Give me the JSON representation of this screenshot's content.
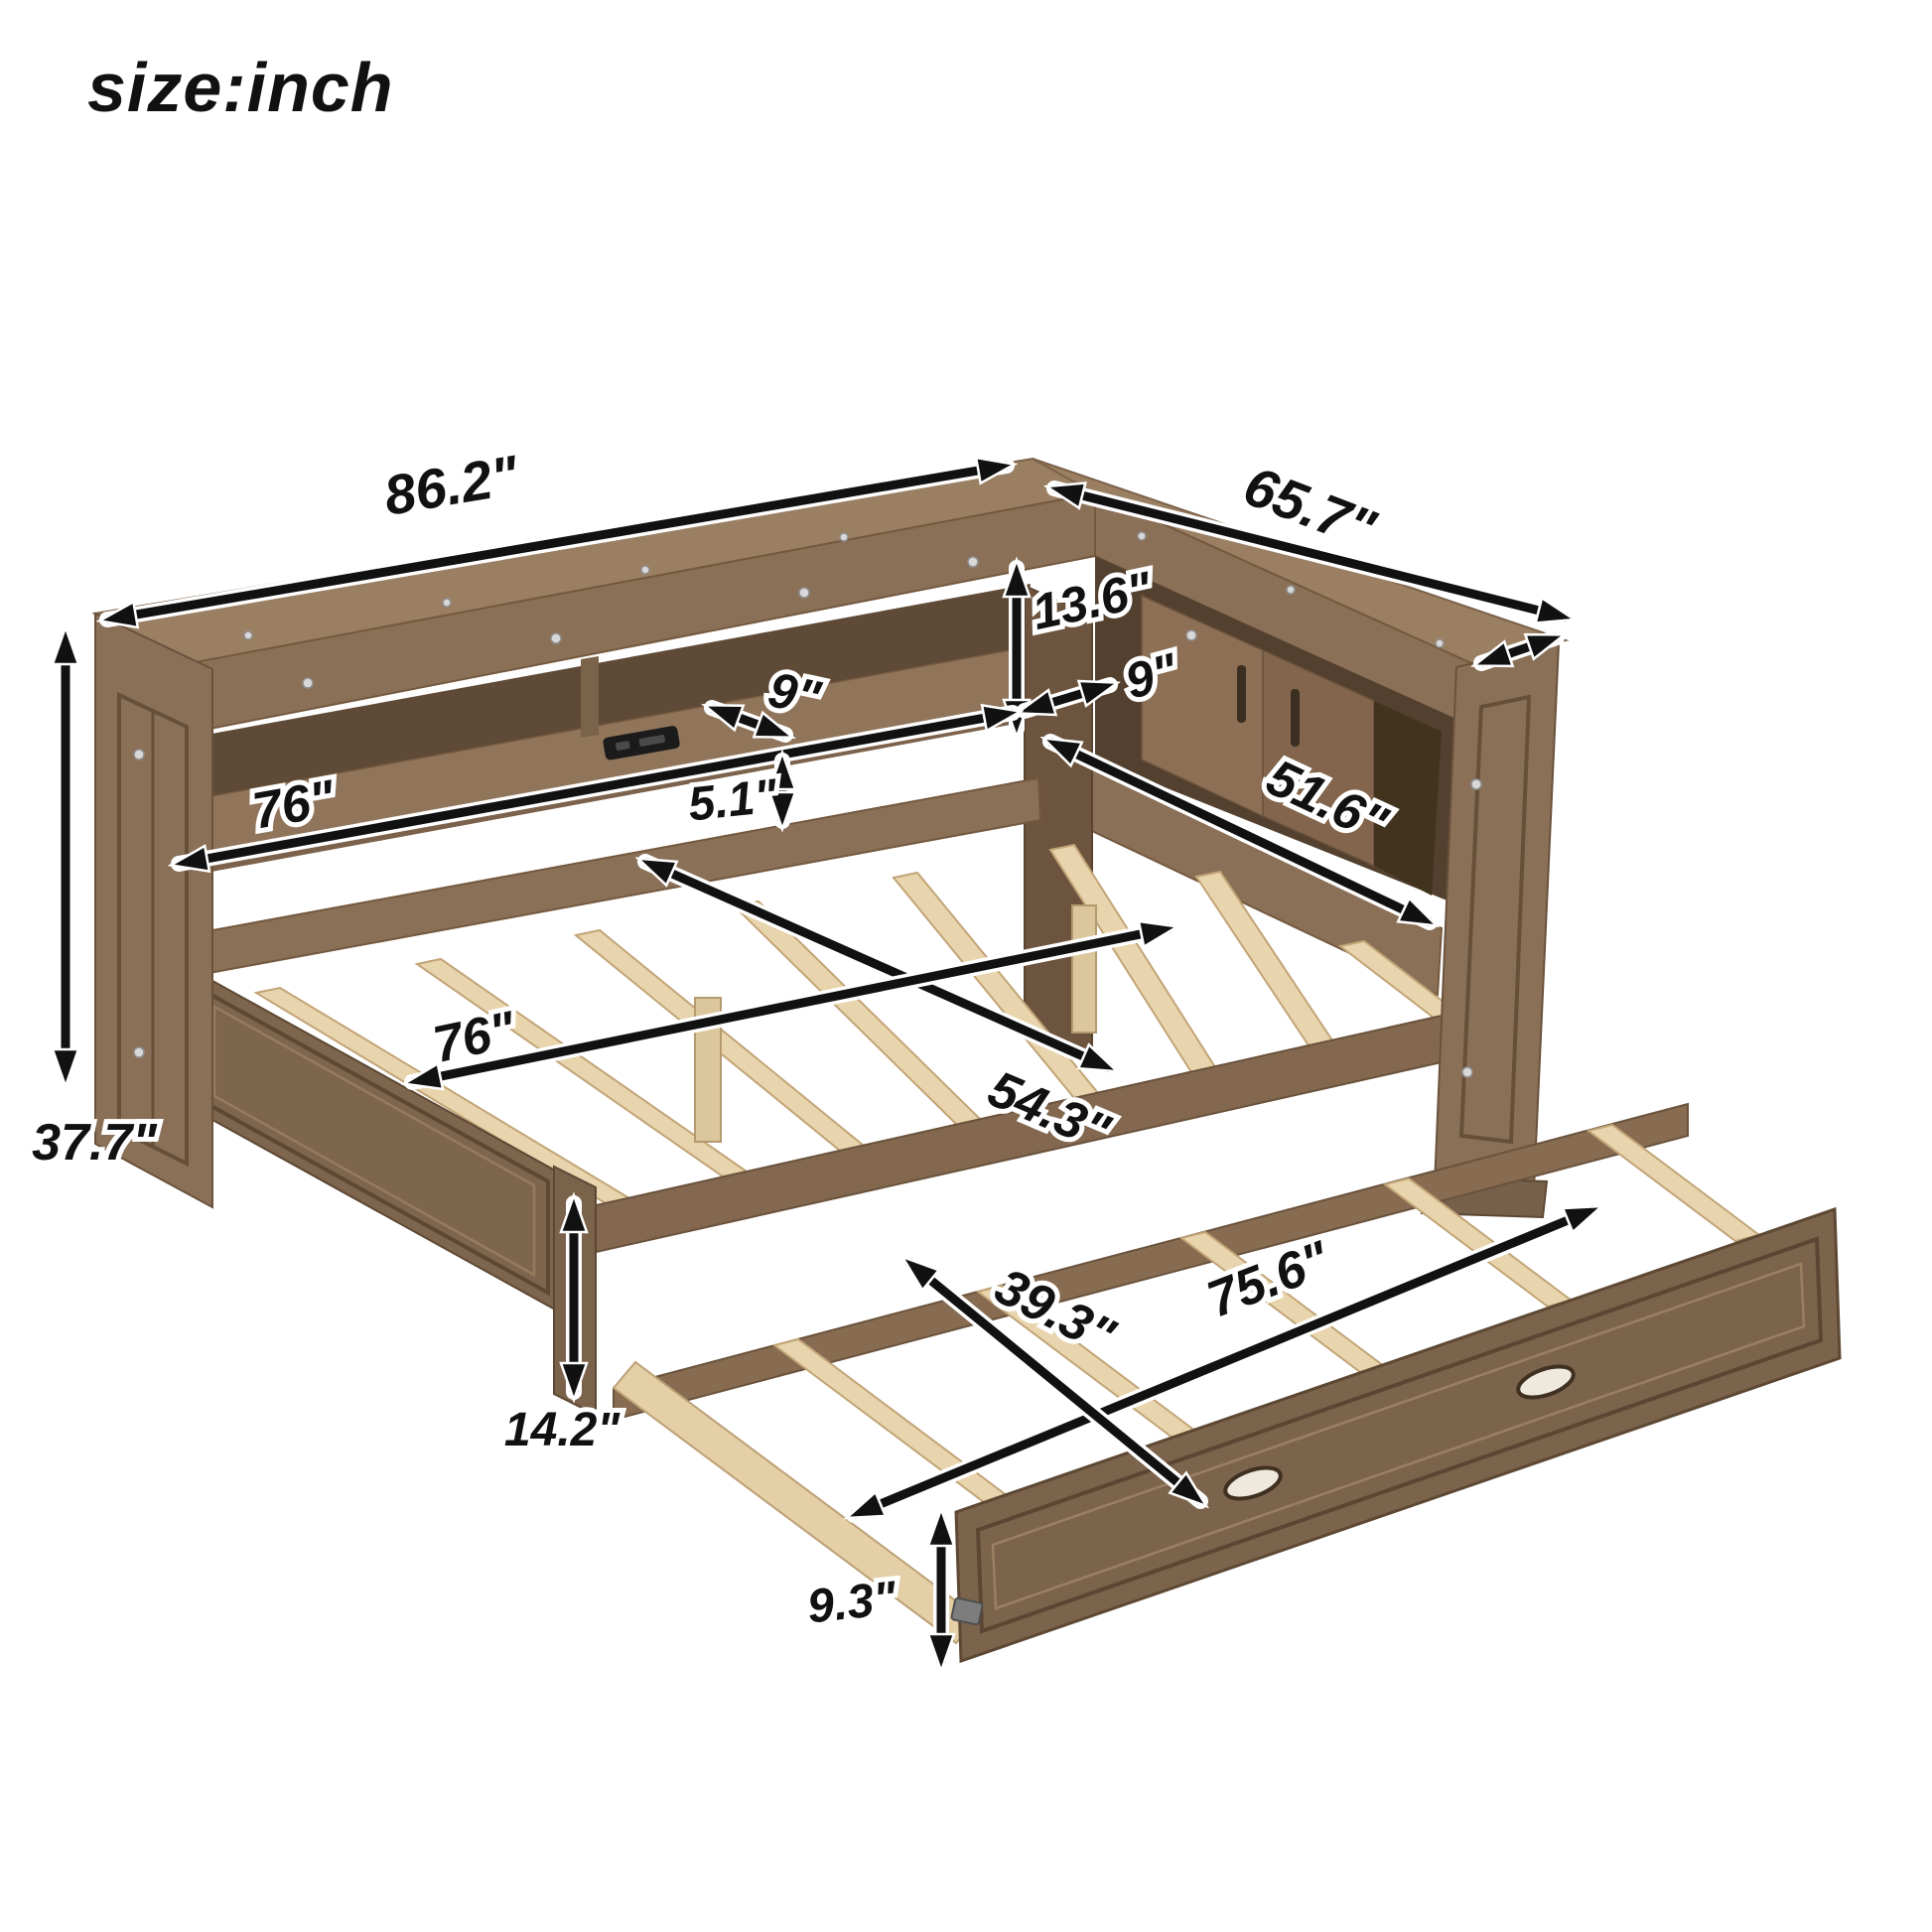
{
  "title": "size:inch",
  "dims": {
    "overall_length": "86.2\"",
    "side_depth": "65.7\"",
    "overall_height": "37.7\"",
    "hutch_opening_height": "13.6\"",
    "shelf_depth_right": "9\"",
    "shelf_depth_left": "9\"",
    "shelf_length": "76\"",
    "shelf_to_bed_gap": "5.1\"",
    "side_shelf_length": "51.6\"",
    "bed_width": "54.3\"",
    "bed_length": "76\"",
    "frame_height": "14.2\"",
    "trundle_length": "75.6\"",
    "trundle_width": "39.3\"",
    "trundle_height": "9.3\""
  },
  "palette": {
    "wood": "#8b7058",
    "wood_dark_interior": "#5f4a37",
    "slat_wood": "#e9d5ad",
    "arrow": "#111111",
    "background": "#ffffff"
  }
}
